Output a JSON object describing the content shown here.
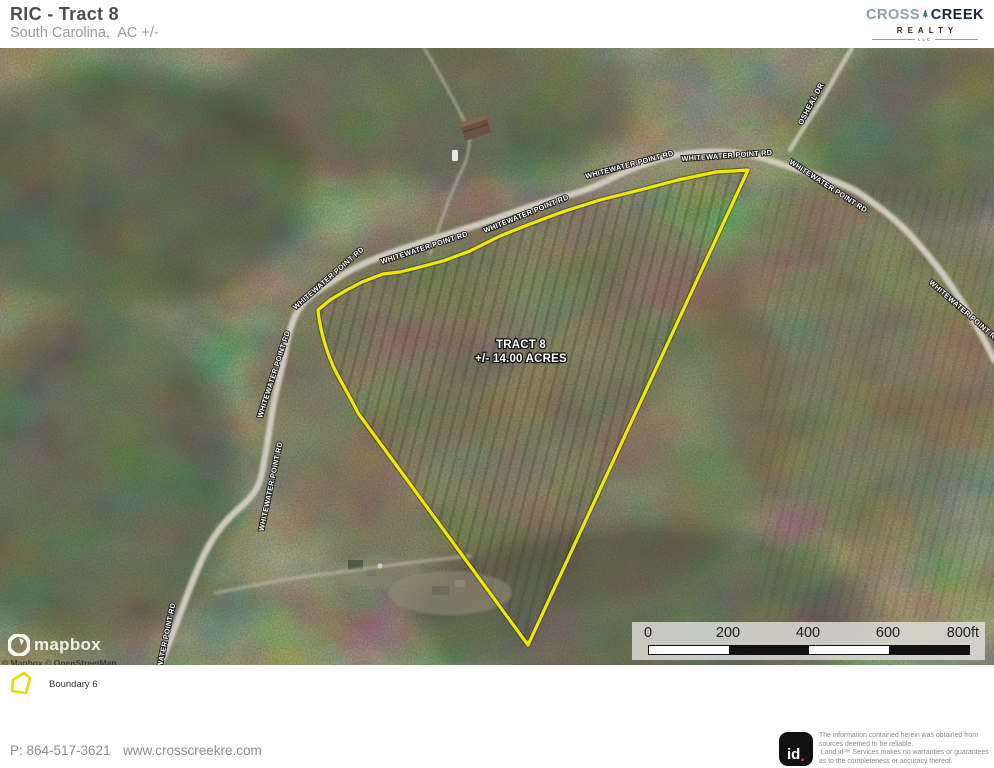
{
  "header": {
    "title": "RIC - Tract 8",
    "subtitle": "South Carolina,  AC +/-"
  },
  "brand": {
    "cross": "CROSS",
    "creek": "CREEK",
    "realty": "REALTY",
    "llc": "LLC"
  },
  "map": {
    "tract_label_line1": "TRACT 8",
    "tract_label_line2": "+/- 14.00 ACRES",
    "boundary_name": "Boundary 6",
    "boundary_color": "#F2E900",
    "road_labels": [
      {
        "text": "WHITEWATER POINT RD"
      },
      {
        "text": "WHITEWATER POINT RD"
      },
      {
        "text": "WHITEWATER POINT RD"
      },
      {
        "text": "WHITEWATER POINT RD"
      },
      {
        "text": "WHITEWATER POINT RD"
      },
      {
        "text": "WHITEWATER POINT RD"
      },
      {
        "text": "WHITEWATER POINT RD"
      },
      {
        "text": "WHITEWATER POINT RD"
      },
      {
        "text": "WHITEWATER POINT RD"
      },
      {
        "text": "WHITEWATER POINT RD"
      },
      {
        "text": "OSHEAL DR"
      }
    ],
    "mapbox_wordmark": "mapbox",
    "attribution": "© Mapbox © OpenStreetMap"
  },
  "scale_bar": {
    "ticks": [
      "0",
      "200",
      "400",
      "600",
      "800ft"
    ]
  },
  "legend": {
    "items": [
      {
        "label": "Boundary 6",
        "color": "#F2E900"
      }
    ]
  },
  "footer": {
    "phone": "P: 864-517-3621",
    "website": "www.crosscreekre.com",
    "badge_id": "id",
    "badge_dot": ".",
    "disclaimer_lines": [
      "The information contained herein was obtained from",
      "sources deemed to be reliable.",
      " Land id™ Services makes no warranties or guarantees",
      "as to the completeness or accuracy thereof."
    ]
  }
}
